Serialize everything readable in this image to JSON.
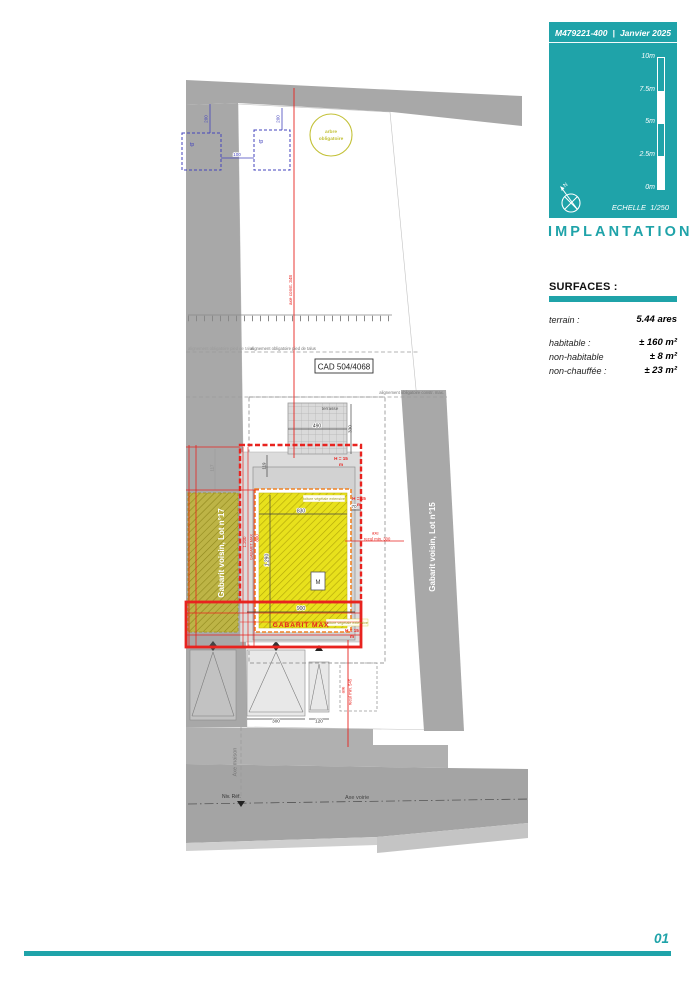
{
  "panel": {
    "ref": "M479221-400",
    "sep": "|",
    "date": "Janvier 2025",
    "scale_ticks": [
      "10m",
      "7.5m",
      "5m",
      "2.5m",
      "0m"
    ],
    "north": "N",
    "echelle_label": "ECHELLE",
    "echelle_value": "1/250",
    "title": "IMPLANTATION",
    "accent_color": "#1fa3a9"
  },
  "surfaces": {
    "heading": "SURFACES :",
    "rows": [
      {
        "label": "terrain :",
        "value": "5.44 ares"
      },
      {
        "label": "habitable :",
        "value": "± 160 m²"
      },
      {
        "label": "non-habitable",
        "value": "± 8 m²"
      },
      {
        "label": "non-chauffée :",
        "value": "± 23 m²"
      }
    ]
  },
  "footer": {
    "page_number": "01"
  },
  "plan": {
    "labels": {
      "tree_line1": "arbre",
      "tree_line2": "obligatoire",
      "tp": "tp",
      "cad": "CAD 504/4068",
      "terrasse": "terrasse",
      "toiture": "toiture végétale extensive",
      "gabarit_max": "GABARIT MAX",
      "lot17": "Gabarit voisin, Lot n°17",
      "lot15": "Gabarit voisin, Lot n°15",
      "axe_voirie": "Axe voirie",
      "axe_maison": "Axe maison",
      "niv_ref": "Niv. Réf.",
      "align_talus": "alignement obligatoire pied de talus",
      "align_constr": "alignement obligatoire constr. max.",
      "axe_const": "axe const. 348",
      "axe_word": "axe",
      "recul_300": "recul min. 300",
      "recul_545": "recul min. 545",
      "h15": "H = 15",
      "h15_unit": "m",
      "meter": "M"
    },
    "dims": {
      "d100": "100",
      "d200": "200",
      "d490": "490",
      "d330": "330",
      "d830": "830",
      "d70": "70",
      "d119": "119",
      "d117": "117",
      "d1290": "1.290",
      "d1200": "1.200",
      "d800": "800",
      "d900": "900",
      "d300": "300",
      "d120": "120"
    },
    "colors": {
      "red": "#e8231f",
      "orange": "#f08223",
      "yellow": "#e8e11c",
      "olive": "#b7ad3a",
      "blue": "#4343bd",
      "road_gray": "#a6a6a6"
    }
  }
}
